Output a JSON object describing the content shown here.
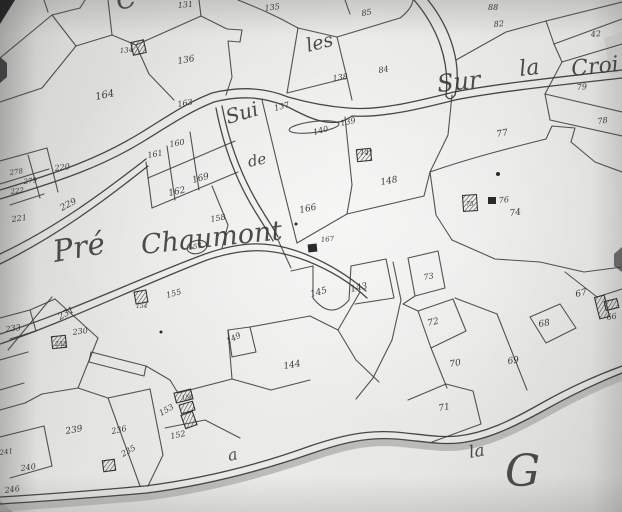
{
  "map": {
    "section_letter": "G",
    "colors": {
      "ink": "#3c3c3a",
      "paper": "#e7e7e5",
      "road_shadow": "#9d9d9b"
    },
    "place_names": [
      {
        "text": "C",
        "x": 118,
        "y": 10,
        "size": 26,
        "rot": -12
      },
      {
        "text": "les",
        "x": 308,
        "y": 52,
        "size": 19,
        "rot": -14
      },
      {
        "text": "Sui",
        "x": 228,
        "y": 124,
        "size": 20,
        "rot": -16
      },
      {
        "text": "de",
        "x": 249,
        "y": 167,
        "size": 15,
        "rot": -12
      },
      {
        "text": "Sur",
        "x": 438,
        "y": 92,
        "size": 24,
        "rot": -6
      },
      {
        "text": "la",
        "x": 520,
        "y": 76,
        "size": 22,
        "rot": -6
      },
      {
        "text": "Croi",
        "x": 572,
        "y": 76,
        "size": 22,
        "rot": -6
      },
      {
        "text": "Pré",
        "x": 55,
        "y": 262,
        "size": 30,
        "rot": -10
      },
      {
        "text": "Chaumont",
        "x": 142,
        "y": 254,
        "size": 27,
        "rot": -6
      },
      {
        "text": "a",
        "x": 229,
        "y": 461,
        "size": 16,
        "rot": -12
      },
      {
        "text": "la",
        "x": 470,
        "y": 458,
        "size": 17,
        "rot": -10
      },
      {
        "text": "G",
        "x": 505,
        "y": 486,
        "size": 44,
        "rot": 0
      }
    ],
    "parcel_labels": [
      {
        "text": "131",
        "x": 178,
        "y": 8,
        "size": 8,
        "rot": -5
      },
      {
        "text": "135",
        "x": 265,
        "y": 11,
        "size": 8,
        "rot": -8
      },
      {
        "text": "134",
        "x": 120,
        "y": 53,
        "size": 7,
        "rot": -5
      },
      {
        "text": "136",
        "x": 178,
        "y": 64,
        "size": 9,
        "rot": -10
      },
      {
        "text": "164",
        "x": 96,
        "y": 100,
        "size": 10,
        "rot": -12
      },
      {
        "text": "163",
        "x": 178,
        "y": 107,
        "size": 8,
        "rot": -10
      },
      {
        "text": "137",
        "x": 275,
        "y": 111,
        "size": 8,
        "rot": -15
      },
      {
        "text": "139",
        "x": 341,
        "y": 126,
        "size": 8,
        "rot": -12
      },
      {
        "text": "140",
        "x": 314,
        "y": 135,
        "size": 8,
        "rot": -15
      },
      {
        "text": "88",
        "x": 488,
        "y": 10,
        "size": 8,
        "rot": 0
      },
      {
        "text": "82",
        "x": 494,
        "y": 27,
        "size": 8,
        "rot": -5
      },
      {
        "text": "42",
        "x": 591,
        "y": 37,
        "size": 8,
        "rot": -5
      },
      {
        "text": "85",
        "x": 362,
        "y": 16,
        "size": 8,
        "rot": -10
      },
      {
        "text": "84",
        "x": 379,
        "y": 73,
        "size": 8,
        "rot": -10
      },
      {
        "text": "138",
        "x": 333,
        "y": 81,
        "size": 8,
        "rot": -8
      },
      {
        "text": "79",
        "x": 577,
        "y": 90,
        "size": 8,
        "rot": -5
      },
      {
        "text": "78",
        "x": 598,
        "y": 124,
        "size": 8,
        "rot": -8
      },
      {
        "text": "77",
        "x": 497,
        "y": 137,
        "size": 9,
        "rot": -10
      },
      {
        "text": "141",
        "x": 360,
        "y": 155,
        "size": 7,
        "rot": 0
      },
      {
        "text": "148",
        "x": 381,
        "y": 185,
        "size": 9,
        "rot": -10
      },
      {
        "text": "161",
        "x": 148,
        "y": 158,
        "size": 8,
        "rot": -10
      },
      {
        "text": "160",
        "x": 170,
        "y": 147,
        "size": 8,
        "rot": -10
      },
      {
        "text": "169",
        "x": 193,
        "y": 183,
        "size": 9,
        "rot": -15
      },
      {
        "text": "162",
        "x": 169,
        "y": 196,
        "size": 9,
        "rot": -12
      },
      {
        "text": "158",
        "x": 211,
        "y": 222,
        "size": 8,
        "rot": -10
      },
      {
        "text": "157",
        "x": 189,
        "y": 250,
        "size": 7,
        "rot": -10
      },
      {
        "text": "166",
        "x": 300,
        "y": 213,
        "size": 9,
        "rot": -12
      },
      {
        "text": "167",
        "x": 321,
        "y": 242,
        "size": 7,
        "rot": -5
      },
      {
        "text": "76",
        "x": 499,
        "y": 203,
        "size": 8,
        "rot": -5
      },
      {
        "text": "75",
        "x": 466,
        "y": 206,
        "size": 6,
        "rot": 0
      },
      {
        "text": "74",
        "x": 510,
        "y": 216,
        "size": 9,
        "rot": -8
      },
      {
        "text": "278",
        "x": 10,
        "y": 175,
        "size": 7,
        "rot": -8
      },
      {
        "text": "279",
        "x": 24,
        "y": 184,
        "size": 7,
        "rot": -8
      },
      {
        "text": "222",
        "x": 11,
        "y": 194,
        "size": 7,
        "rot": -8
      },
      {
        "text": "220",
        "x": 55,
        "y": 171,
        "size": 8,
        "rot": -8
      },
      {
        "text": "229",
        "x": 62,
        "y": 211,
        "size": 9,
        "rot": -28
      },
      {
        "text": "221",
        "x": 12,
        "y": 222,
        "size": 8,
        "rot": -8
      },
      {
        "text": "233",
        "x": 6,
        "y": 332,
        "size": 8,
        "rot": -8
      },
      {
        "text": "231",
        "x": 60,
        "y": 320,
        "size": 9,
        "rot": -30
      },
      {
        "text": "230",
        "x": 73,
        "y": 335,
        "size": 8,
        "rot": -8
      },
      {
        "text": "232",
        "x": 55,
        "y": 346,
        "size": 6,
        "rot": 0
      },
      {
        "text": "155",
        "x": 167,
        "y": 298,
        "size": 8,
        "rot": -15
      },
      {
        "text": "154",
        "x": 136,
        "y": 308,
        "size": 6,
        "rot": 0
      },
      {
        "text": "149",
        "x": 228,
        "y": 344,
        "size": 8,
        "rot": -28
      },
      {
        "text": "144",
        "x": 284,
        "y": 369,
        "size": 9,
        "rot": -10
      },
      {
        "text": "145",
        "x": 311,
        "y": 297,
        "size": 9,
        "rot": -15
      },
      {
        "text": "143",
        "x": 351,
        "y": 292,
        "size": 9,
        "rot": -12
      },
      {
        "text": "239",
        "x": 66,
        "y": 434,
        "size": 9,
        "rot": -10
      },
      {
        "text": "236",
        "x": 112,
        "y": 434,
        "size": 8,
        "rot": -12
      },
      {
        "text": "235",
        "x": 123,
        "y": 457,
        "size": 8,
        "rot": -30
      },
      {
        "text": "240",
        "x": 21,
        "y": 471,
        "size": 8,
        "rot": -8
      },
      {
        "text": "246",
        "x": 5,
        "y": 493,
        "size": 8,
        "rot": -8
      },
      {
        "text": "241",
        "x": 0,
        "y": 455,
        "size": 7,
        "rot": -8
      },
      {
        "text": "153",
        "x": 161,
        "y": 416,
        "size": 8,
        "rot": -30
      },
      {
        "text": "150",
        "x": 182,
        "y": 400,
        "size": 6,
        "rot": -10
      },
      {
        "text": "152",
        "x": 171,
        "y": 439,
        "size": 8,
        "rot": -12
      },
      {
        "text": "73",
        "x": 424,
        "y": 280,
        "size": 8,
        "rot": -10
      },
      {
        "text": "72",
        "x": 428,
        "y": 326,
        "size": 9,
        "rot": -12
      },
      {
        "text": "70",
        "x": 450,
        "y": 367,
        "size": 9,
        "rot": -10
      },
      {
        "text": "71",
        "x": 439,
        "y": 411,
        "size": 9,
        "rot": -10
      },
      {
        "text": "69",
        "x": 508,
        "y": 364,
        "size": 9,
        "rot": -8
      },
      {
        "text": "68",
        "x": 539,
        "y": 327,
        "size": 9,
        "rot": -10
      },
      {
        "text": "67",
        "x": 576,
        "y": 297,
        "size": 9,
        "rot": -12
      },
      {
        "text": "66",
        "x": 607,
        "y": 320,
        "size": 8,
        "rot": -8
      }
    ],
    "roads": [
      {
        "d": "M0,190 C60,172 100,158 142,132 C168,116 186,103 212,93 C240,86 266,88 288,97 C302,101 322,106 348,108 C381,111 421,100 454,92 C500,83 570,76 622,70"
      },
      {
        "d": "M0,199 C60,181 102,167 144,141 C170,125 189,112 214,102 C242,95 262,97 286,106 C298,112 312,120 326,122 C340,124 346,120 352,116 C384,118 423,108 455,100 C500,91 570,84 622,78"
      },
      {
        "d": "M0,264 C55,237 103,202 148,166"
      },
      {
        "d": "M0,254 C55,228 101,194 146,159"
      },
      {
        "d": "M0,334 C70,312 140,278 205,254 C245,240 272,241 305,254 C330,264 350,277 366,291"
      },
      {
        "d": "M0,344 C70,320 142,285 207,260 C246,247 273,248 307,261 C332,271 352,284 367,298"
      },
      {
        "d": "M414,0 C438,28 450,62 446,96"
      },
      {
        "d": "M428,0 C452,30 462,66 455,95"
      },
      {
        "d": "M446,96 Q450,102 455,95"
      },
      {
        "d": "M216,108 C224,150 238,185 258,216 C264,226 269,233 273,241"
      },
      {
        "d": "M222,106 C230,148 244,182 263,212 C269,222 274,229 278,237"
      },
      {
        "d": "M0,497 C50,494 100,490 145,486 C200,479 255,466 310,446 C340,436 365,430 395,432 C420,434 440,438 458,436 C485,433 510,421 540,404 C570,387 600,374 622,366"
      },
      {
        "d": "M0,504 C50,501 102,497 147,493 C202,486 258,472 313,453 C342,443 366,437 396,439 C421,441 441,445 459,443 C486,440 512,428 543,411 C573,394 602,381 622,373"
      }
    ],
    "road_shadow": {
      "d": "M0,508 C50,505 102,501 147,497 C202,490 258,476 313,457 C342,447 366,441 396,443 C421,445 441,449 459,447 C486,444 512,432 543,415 C573,398 602,385 622,377",
      "width": 7
    },
    "parcel_lines": [
      {
        "d": "M0,58 L52,15"
      },
      {
        "d": "M52,15 L80,8"
      },
      {
        "d": "M44,0 L48,12"
      },
      {
        "d": "M80,8 L85,0"
      },
      {
        "d": "M52,15 L76,46"
      },
      {
        "d": "M0,102 L42,88 L76,46"
      },
      {
        "d": "M76,46 L112,35"
      },
      {
        "d": "M108,0 L112,35"
      },
      {
        "d": "M112,35 L136,45"
      },
      {
        "d": "M136,45 L201,16"
      },
      {
        "d": "M201,16 L199,0"
      },
      {
        "d": "M136,45 L149,74 L174,100"
      },
      {
        "d": "M201,16 L227,29 L242,30 L240,42 L228,41 L232,77 L226,95"
      },
      {
        "d": "M0,161 L47,148"
      },
      {
        "d": "M0,184 L49,169"
      },
      {
        "d": "M28,155 L40,198"
      },
      {
        "d": "M10,205 L44,194"
      },
      {
        "d": "M47,148 L58,192"
      },
      {
        "d": "M238,0 C258,8 275,15 298,28"
      },
      {
        "d": "M298,28 L287,93"
      },
      {
        "d": "M298,28 L337,37"
      },
      {
        "d": "M337,37 L347,78"
      },
      {
        "d": "M287,93 L347,78"
      },
      {
        "d": "M337,37 L400,18 C408,12 412,6 413,0"
      },
      {
        "d": "M347,78 L352,100"
      },
      {
        "d": "M345,0 L350,14"
      },
      {
        "d": "M456,60 L506,32 L546,21"
      },
      {
        "d": "M546,21 L554,44"
      },
      {
        "d": "M554,44 L622,19"
      },
      {
        "d": "M546,21 L622,2"
      },
      {
        "d": "M554,44 L562,62 L622,44"
      },
      {
        "d": "M562,62 L545,94"
      },
      {
        "d": "M545,94 L622,112"
      },
      {
        "d": "M545,94 L550,120 L622,136"
      },
      {
        "d": "M452,95 L448,135 L430,172"
      },
      {
        "d": "M430,172 C470,158 510,148 546,139"
      },
      {
        "d": "M546,139 L552,126 L575,128 L571,142"
      },
      {
        "d": "M571,142 L595,162 L622,172"
      },
      {
        "d": "M430,172 L436,215 L452,240"
      },
      {
        "d": "M452,240 L495,259 L540,262 L584,272 L622,267"
      },
      {
        "d": "M565,272 L597,297"
      },
      {
        "d": "M597,297 L622,289"
      },
      {
        "d": "M530,317 L560,304 L576,328 L546,343 Z"
      },
      {
        "d": "M497,314 L527,390"
      },
      {
        "d": "M455,298 L497,314"
      },
      {
        "d": "M408,258 L438,251 L445,288 L415,296 Z"
      },
      {
        "d": "M418,311 L453,299 L466,331 L431,348 Z"
      },
      {
        "d": "M415,296 L403,304 L418,311"
      },
      {
        "d": "M431,348 L447,388"
      },
      {
        "d": "M408,400 L446,384 L473,391 L481,424 L432,442"
      },
      {
        "d": "M393,262 L401,300 L392,340"
      },
      {
        "d": "M392,340 L373,378 L356,399"
      },
      {
        "d": "M313,266 L313,298 Q331,321 349,300 L351,266"
      },
      {
        "d": "M351,266 L386,259"
      },
      {
        "d": "M386,259 L394,298 L355,304"
      },
      {
        "d": "M313,266 L291,271"
      },
      {
        "d": "M228,330 L250,327 L256,352 L232,357 Z"
      },
      {
        "d": "M250,327 L310,316"
      },
      {
        "d": "M310,316 L338,330 L360,292"
      },
      {
        "d": "M338,330 L356,360 L379,382"
      },
      {
        "d": "M228,330 L232,379"
      },
      {
        "d": "M91,352 L146,366 L144,376 L89,362 Z"
      },
      {
        "d": "M146,366 L170,380 L178,393"
      },
      {
        "d": "M178,393 L232,379"
      },
      {
        "d": "M232,379 L271,390 L310,380"
      },
      {
        "d": "M0,318 L30,310 L55,299"
      },
      {
        "d": "M30,310 L36,331 L10,339"
      },
      {
        "d": "M8,350 L52,297"
      },
      {
        "d": "M55,299 L98,338"
      },
      {
        "d": "M98,338 L78,388"
      },
      {
        "d": "M78,388 L42,394"
      },
      {
        "d": "M25,403 L42,394"
      },
      {
        "d": "M25,403 L0,410"
      },
      {
        "d": "M78,388 L108,398"
      },
      {
        "d": "M108,398 L150,389"
      },
      {
        "d": "M108,398 L140,486"
      },
      {
        "d": "M150,389 L163,455 L148,486"
      },
      {
        "d": "M0,437 L44,426"
      },
      {
        "d": "M44,426 L52,466"
      },
      {
        "d": "M52,466 L10,478"
      },
      {
        "d": "M0,360 L28,352"
      },
      {
        "d": "M0,390 L24,383"
      },
      {
        "d": "M165,428 L205,420 L240,438"
      },
      {
        "d": "M146,162 L152,208"
      },
      {
        "d": "M152,208 L238,172"
      },
      {
        "d": "M167,146 L175,200"
      },
      {
        "d": "M190,132 L199,190"
      },
      {
        "d": "M148,178 L235,141"
      },
      {
        "d": "M212,186 L228,225 L222,248"
      },
      {
        "d": "M262,100 L280,175 L297,243"
      },
      {
        "d": "M345,117 L352,185 L347,214"
      },
      {
        "d": "M297,243 L347,214"
      },
      {
        "d": "M347,214 L424,196"
      },
      {
        "d": "M424,196 L430,172"
      },
      {
        "d": "M278,240 L291,268"
      }
    ],
    "buildings_hatched": [
      {
        "x": 132,
        "y": 41,
        "w": 13,
        "h": 13,
        "rot": -12
      },
      {
        "x": 357,
        "y": 149,
        "w": 14,
        "h": 12,
        "rot": -6
      },
      {
        "x": 463,
        "y": 195,
        "w": 14,
        "h": 16,
        "rot": -4
      },
      {
        "x": 135,
        "y": 291,
        "w": 12,
        "h": 12,
        "rot": -10
      },
      {
        "x": 52,
        "y": 336,
        "w": 14,
        "h": 12,
        "rot": -6
      },
      {
        "x": 175,
        "y": 391,
        "w": 17,
        "h": 10,
        "rot": -14
      },
      {
        "x": 180,
        "y": 403,
        "w": 14,
        "h": 9,
        "rot": -16
      },
      {
        "x": 183,
        "y": 413,
        "w": 12,
        "h": 14,
        "rot": -20
      },
      {
        "x": 103,
        "y": 460,
        "w": 12,
        "h": 11,
        "rot": -8
      },
      {
        "x": 597,
        "y": 296,
        "w": 10,
        "h": 22,
        "rot": -14
      },
      {
        "x": 605,
        "y": 300,
        "w": 13,
        "h": 9,
        "rot": -14
      }
    ],
    "buildings_solid": [
      {
        "x": 488,
        "y": 197,
        "w": 8,
        "h": 7,
        "rot": 0
      },
      {
        "x": 308,
        "y": 244,
        "w": 9,
        "h": 8,
        "rot": -6
      }
    ],
    "dots": [
      {
        "x": 498,
        "y": 174,
        "r": 2
      },
      {
        "x": 296,
        "y": 224,
        "r": 1.5
      },
      {
        "x": 161,
        "y": 332,
        "r": 1.5
      }
    ],
    "ovals": [
      {
        "cx": 314,
        "cy": 127,
        "rx": 25,
        "ry": 5.5,
        "rot": -7
      },
      {
        "cx": 197,
        "cy": 247,
        "rx": 10,
        "ry": 6.5,
        "rot": -14
      }
    ],
    "artifacts": [
      {
        "d": "M0,0 L15,0 L0,24 Z",
        "fill": "#1b1b1b",
        "opacity": 0.92
      },
      {
        "d": "M0,57 L7,63 L7,77 L0,83 Z",
        "fill": "#2f2f2f",
        "opacity": 0.85
      },
      {
        "d": "M622,247 L614,254 L614,266 L622,272 Z",
        "fill": "#3a3a3a",
        "opacity": 0.7
      },
      {
        "d": "M0,512 L0,501 L13,512 Z",
        "fill": "#6b6b69",
        "opacity": 0.5
      },
      {
        "d": "M604,38 L622,32 L622,72 L610,74 Z",
        "fill": "#b9b9b7",
        "opacity": 0.5
      }
    ]
  }
}
